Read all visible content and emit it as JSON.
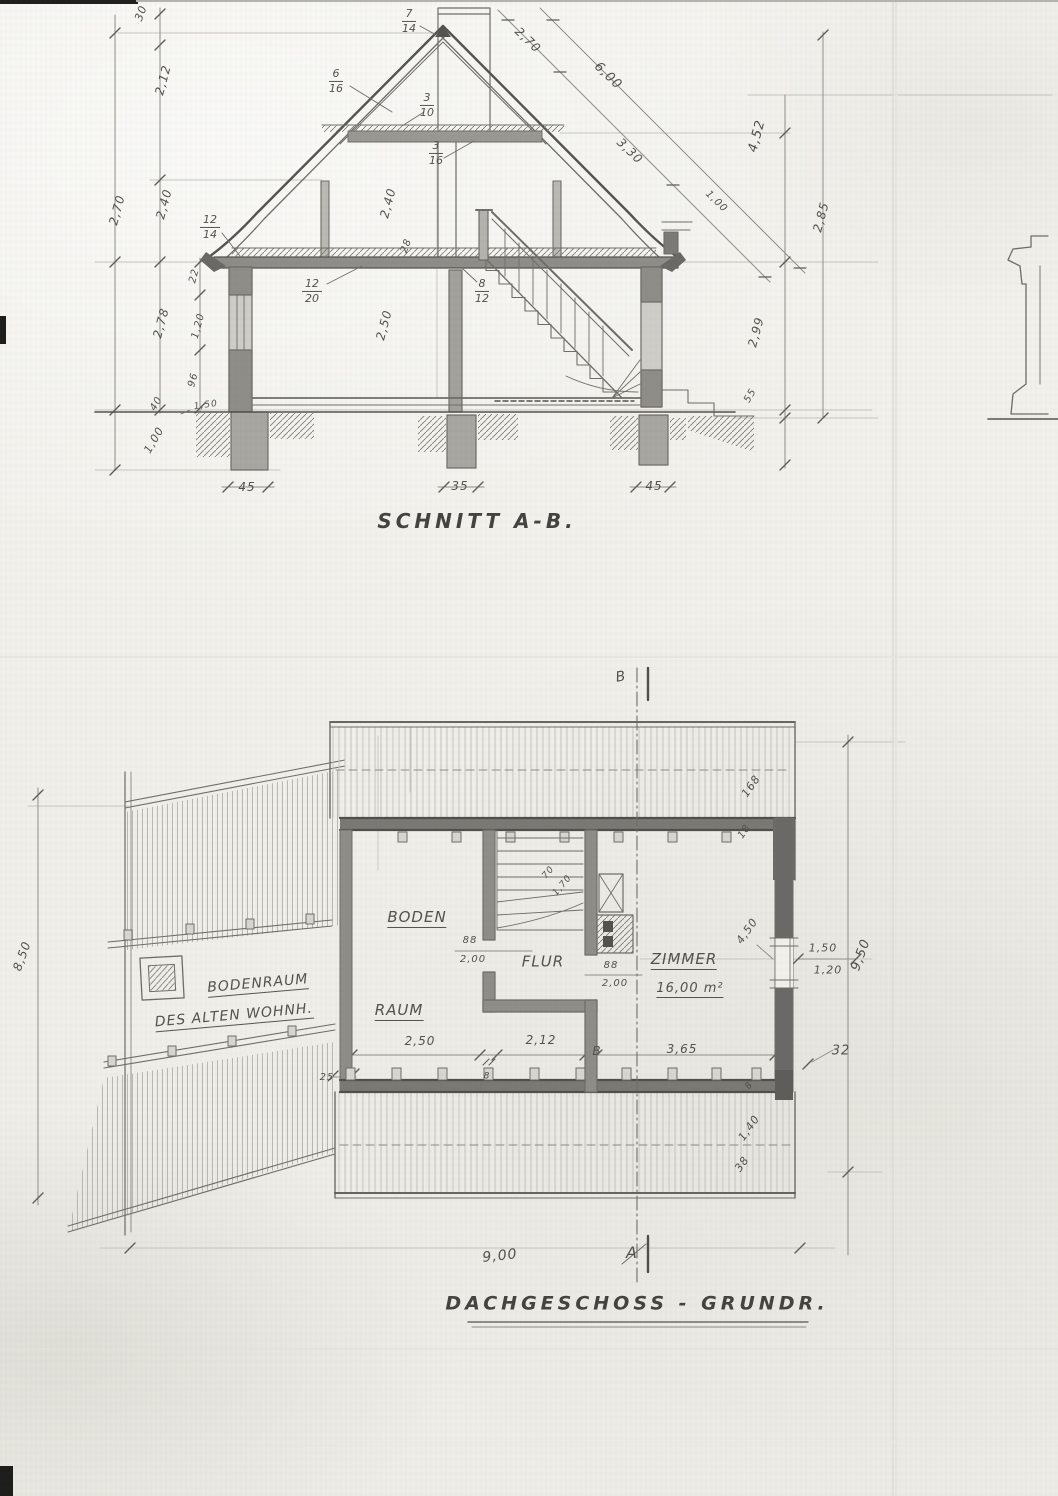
{
  "document": {
    "type": "scanned hand-drawn architectural blueprint",
    "language": "German",
    "pencil_color": "#6f6d68",
    "paper_color": "#f2f1ec"
  },
  "section": {
    "title": "SCHNITT A-B.",
    "labels": [
      {
        "n": "section-title",
        "t": "SCHNITT A-B.",
        "x": 477,
        "y": 521,
        "s": 20,
        "cls": "title"
      },
      {
        "n": "dim-30",
        "t": "30",
        "x": 141,
        "y": 13,
        "r": -70,
        "s": 11
      },
      {
        "n": "dim-2-12",
        "t": "2,12",
        "x": 163,
        "y": 80,
        "r": -75,
        "s": 12
      },
      {
        "n": "dim-2-40-left",
        "t": "2,40",
        "x": 164,
        "y": 204,
        "r": -75,
        "s": 12
      },
      {
        "n": "dim-2-70-left",
        "t": "2,70",
        "x": 117,
        "y": 210,
        "r": -75,
        "s": 12
      },
      {
        "n": "dim-2-78",
        "t": "2,78",
        "x": 161,
        "y": 323,
        "r": -75,
        "s": 12
      },
      {
        "n": "dim-22",
        "t": "22",
        "x": 195,
        "y": 276,
        "r": -75,
        "s": 10
      },
      {
        "n": "dim-1-20",
        "t": "1,20",
        "x": 199,
        "y": 326,
        "r": -75,
        "s": 10
      },
      {
        "n": "dim-96",
        "t": "96",
        "x": 194,
        "y": 380,
        "r": -75,
        "s": 10
      },
      {
        "n": "dim-40",
        "t": "40",
        "x": 157,
        "y": 404,
        "r": -60,
        "s": 10
      },
      {
        "n": "dim-1-00-foundation",
        "t": "1,00",
        "x": 154,
        "y": 440,
        "r": -60,
        "s": 11
      },
      {
        "n": "dim-1-50-ground",
        "t": "1,50",
        "x": 206,
        "y": 406,
        "r": -8,
        "s": 9
      },
      {
        "n": "dim-45-left",
        "t": "45",
        "x": 247,
        "y": 487,
        "s": 12
      },
      {
        "n": "dim-35-middle",
        "t": "35",
        "x": 460,
        "y": 486,
        "s": 12
      },
      {
        "n": "dim-45-right",
        "t": "45",
        "x": 654,
        "y": 486,
        "s": 12
      },
      {
        "n": "dim-28-beam",
        "t": "28",
        "x": 407,
        "y": 246,
        "r": -70,
        "s": 10
      },
      {
        "n": "dim-2-40-attic",
        "t": "2,40",
        "x": 388,
        "y": 203,
        "r": -75,
        "s": 12
      },
      {
        "n": "dim-2-50-room",
        "t": "2,50",
        "x": 384,
        "y": 325,
        "r": -75,
        "s": 12
      },
      {
        "n": "dim-2-70-roof",
        "t": "2,70",
        "x": 528,
        "y": 40,
        "r": 44,
        "s": 12
      },
      {
        "n": "dim-6-00-roof",
        "t": "6,00",
        "x": 608,
        "y": 76,
        "r": 44,
        "s": 13
      },
      {
        "n": "dim-3-30-roof",
        "t": "3,30",
        "x": 630,
        "y": 151,
        "r": 44,
        "s": 12
      },
      {
        "n": "dim-1-00-roof",
        "t": "1,00",
        "x": 716,
        "y": 202,
        "r": 44,
        "s": 10
      },
      {
        "n": "dim-4-52",
        "t": "4,52",
        "x": 757,
        "y": 136,
        "r": -75,
        "s": 13
      },
      {
        "n": "dim-2-85",
        "t": "2,85",
        "x": 821,
        "y": 217,
        "r": -75,
        "s": 12
      },
      {
        "n": "dim-2-99",
        "t": "2,99",
        "x": 756,
        "y": 332,
        "r": -75,
        "s": 12
      },
      {
        "n": "dim-55",
        "t": "55",
        "x": 751,
        "y": 396,
        "r": -60,
        "s": 10
      }
    ],
    "timber": [
      {
        "n": "timber-7-14",
        "a": "7",
        "b": "14",
        "x": 409,
        "y": 21
      },
      {
        "n": "timber-6-16",
        "a": "6",
        "b": "16",
        "x": 336,
        "y": 81
      },
      {
        "n": "timber-3-10",
        "a": "3",
        "b": "10",
        "x": 427,
        "y": 105
      },
      {
        "n": "timber-3-16",
        "a": "3",
        "b": "16",
        "x": 436,
        "y": 153
      },
      {
        "n": "timber-12-14",
        "a": "12",
        "b": "14",
        "x": 210,
        "y": 227
      },
      {
        "n": "timber-12-20",
        "a": "12",
        "b": "20",
        "x": 312,
        "y": 291
      },
      {
        "n": "timber-8-12",
        "a": "8",
        "b": "12",
        "x": 482,
        "y": 291
      }
    ]
  },
  "plan": {
    "title": "DACHGESCHOSS - GRUNDR.",
    "labels": [
      {
        "n": "plan-title",
        "t": "DACHGESCHOSS - GRUNDR.",
        "x": 637,
        "y": 1304,
        "s": 19,
        "cls": "title"
      },
      {
        "n": "room-label-boden",
        "t": "BODEN",
        "x": 417,
        "y": 919,
        "s": 15,
        "u": 1
      },
      {
        "n": "room-label-raum",
        "t": "RAUM",
        "x": 399,
        "y": 1012,
        "s": 15,
        "u": 1
      },
      {
        "n": "room-label-flur",
        "t": "FLUR",
        "x": 543,
        "y": 962,
        "s": 15
      },
      {
        "n": "room-label-zimmer",
        "t": "ZIMMER",
        "x": 684,
        "y": 961,
        "s": 15,
        "u": 1
      },
      {
        "n": "zimmer-area",
        "t": "16,00 m²",
        "x": 690,
        "y": 990,
        "s": 13,
        "u": 1
      },
      {
        "n": "old-house-label-1",
        "t": "BODENRAUM",
        "x": 258,
        "y": 985,
        "r": -5,
        "s": 14,
        "u": 1
      },
      {
        "n": "old-house-label-2",
        "t": "DES ALTEN WOHNH.",
        "x": 234,
        "y": 1017,
        "r": -5,
        "s": 14,
        "u": 1
      },
      {
        "n": "dim-8-50",
        "t": "8,50",
        "x": 22,
        "y": 956,
        "r": -70,
        "s": 12
      },
      {
        "n": "dim-9-50",
        "t": "9,50",
        "x": 861,
        "y": 955,
        "r": -70,
        "s": 13
      },
      {
        "n": "dim-9-00",
        "t": "9,00",
        "x": 500,
        "y": 1256,
        "r": -6,
        "s": 14
      },
      {
        "n": "section-marker-a",
        "t": "A",
        "x": 632,
        "y": 1253,
        "s": 16
      },
      {
        "n": "section-marker-b",
        "t": "B",
        "x": 621,
        "y": 677,
        "r": -10,
        "s": 14
      },
      {
        "n": "dim-168",
        "t": "168",
        "x": 751,
        "y": 786,
        "r": -55,
        "s": 11
      },
      {
        "n": "dim-18",
        "t": "18",
        "x": 745,
        "y": 832,
        "r": -55,
        "s": 10
      },
      {
        "n": "dim-1-40",
        "t": "1,40",
        "x": 749,
        "y": 1128,
        "r": -55,
        "s": 11
      },
      {
        "n": "dim-38",
        "t": "38",
        "x": 742,
        "y": 1164,
        "r": -55,
        "s": 11
      },
      {
        "n": "dim-8-wall",
        "t": "8",
        "x": 750,
        "y": 1086,
        "r": -55,
        "s": 9
      },
      {
        "n": "dim-25",
        "t": "25",
        "x": 327,
        "y": 1078,
        "s": 10
      },
      {
        "n": "dim-32",
        "t": "32",
        "x": 841,
        "y": 1051,
        "s": 13
      },
      {
        "n": "dim-2-50-plan",
        "t": "2,50",
        "x": 420,
        "y": 1041,
        "s": 12
      },
      {
        "n": "dim-2-12-plan",
        "t": "2,12",
        "x": 541,
        "y": 1040,
        "s": 12
      },
      {
        "n": "dim-3-65",
        "t": "3,65",
        "x": 682,
        "y": 1049,
        "s": 12
      },
      {
        "n": "chain-marker-b",
        "t": "B",
        "x": 597,
        "y": 1051,
        "s": 12
      },
      {
        "n": "dim-8-chain",
        "t": "8",
        "x": 487,
        "y": 1077,
        "s": 9
      },
      {
        "n": "window-dim-1-50",
        "t": "1,50",
        "x": 823,
        "y": 948,
        "s": 11
      },
      {
        "n": "window-dim-1-20",
        "t": "1,20",
        "x": 828,
        "y": 970,
        "s": 11
      },
      {
        "n": "dim-4-50",
        "t": "4,50",
        "x": 747,
        "y": 931,
        "r": -55,
        "s": 11
      },
      {
        "n": "door-dim-88-a",
        "t": "88",
        "x": 470,
        "y": 941,
        "s": 10
      },
      {
        "n": "door-dim-2-00-a",
        "t": "2,00",
        "x": 473,
        "y": 960,
        "s": 10
      },
      {
        "n": "door-dim-88-b",
        "t": "88",
        "x": 611,
        "y": 966,
        "s": 10
      },
      {
        "n": "door-dim-2-00-b",
        "t": "2,00",
        "x": 615,
        "y": 984,
        "s": 10
      },
      {
        "n": "window-dim-70",
        "t": "70",
        "x": 549,
        "y": 873,
        "r": -50,
        "s": 9
      },
      {
        "n": "window-dim-1-70",
        "t": "1,70",
        "x": 563,
        "y": 886,
        "r": -50,
        "s": 9
      }
    ]
  }
}
